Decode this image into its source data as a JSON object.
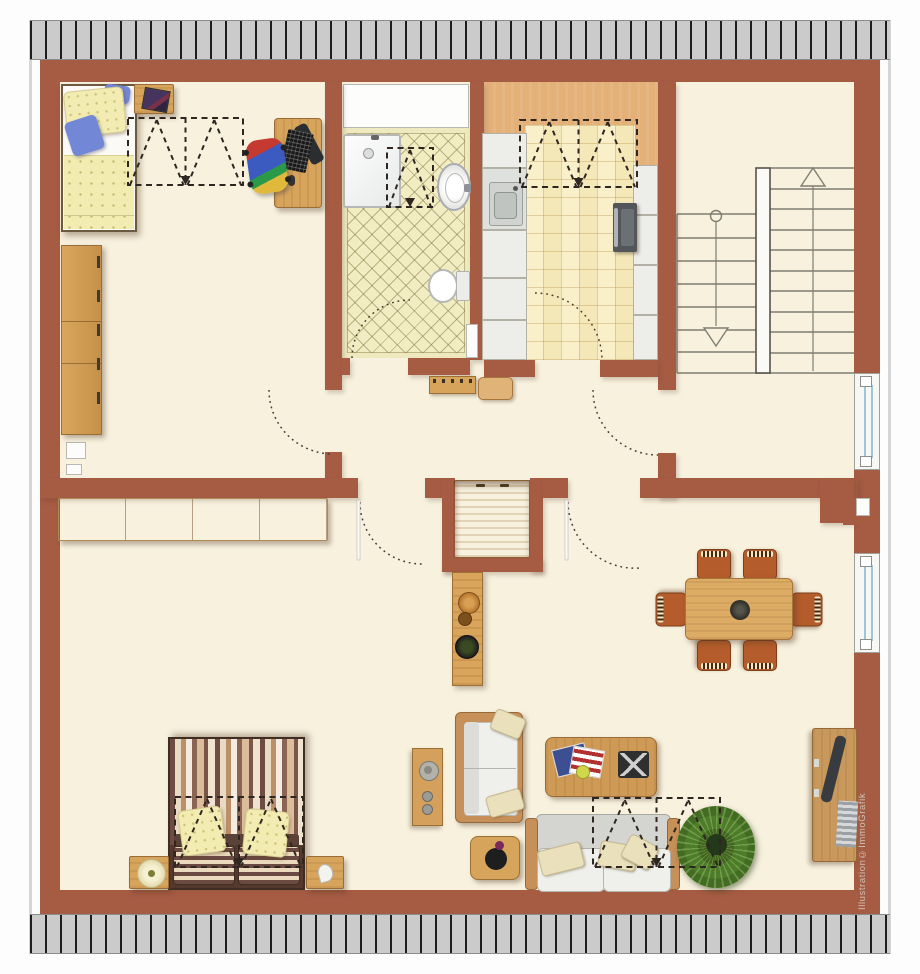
{
  "watermark": "Illustration©ImmoGrafik",
  "palette": {
    "wall": "#a65b43",
    "floor": "#f7f1de",
    "roofHatch": "#cbcbcb",
    "hatchLine": "#1e1e1e",
    "kitchenFloor": "#e3b078",
    "kitchenTile": "#f6ebc0",
    "bathTile": "#f1ecc2",
    "wood": "#d7a45c",
    "woodDark": "#9a6d38",
    "bedding": "#f2ecb2",
    "blue": "#7287d6",
    "chairOrange": "#b45c2b",
    "glass": "#9fc6d8",
    "marker": "#2e2620",
    "arc": "#4a3b2e",
    "stairLine": "#7e7e72",
    "watermarkColor": "#cdc3b8"
  },
  "inventory": {
    "rooms": [
      "bedroom-office",
      "bathroom",
      "kitchen",
      "stairwell",
      "hallway",
      "bedroom",
      "living-dining-room"
    ],
    "symbols": [
      "roof-hatch-border",
      "roof-window-marker x5",
      "door-swing-arc x6",
      "wall-window x2",
      "stair-flight-up",
      "stair-flight-down",
      "wall-niche x4"
    ],
    "furniture": [
      "single-bed",
      "nightstand-picture",
      "office-desk-computer",
      "office-chair",
      "wardrobe",
      "shower",
      "wash-basin",
      "toilet",
      "kitchen-cabinets",
      "kitchen-sink",
      "oven",
      "coat-bench",
      "stool",
      "built-in-closet",
      "sideboard",
      "counter-with-bowls",
      "double-bed",
      "nightstand-lamp",
      "nightstand",
      "wall-shelf",
      "loveseat",
      "side-table-plant",
      "sofa",
      "coffee-table-magazines",
      "chessboard",
      "potted-plant",
      "dining-table",
      "dining-chair x6",
      "desk",
      "desk-chair"
    ]
  }
}
